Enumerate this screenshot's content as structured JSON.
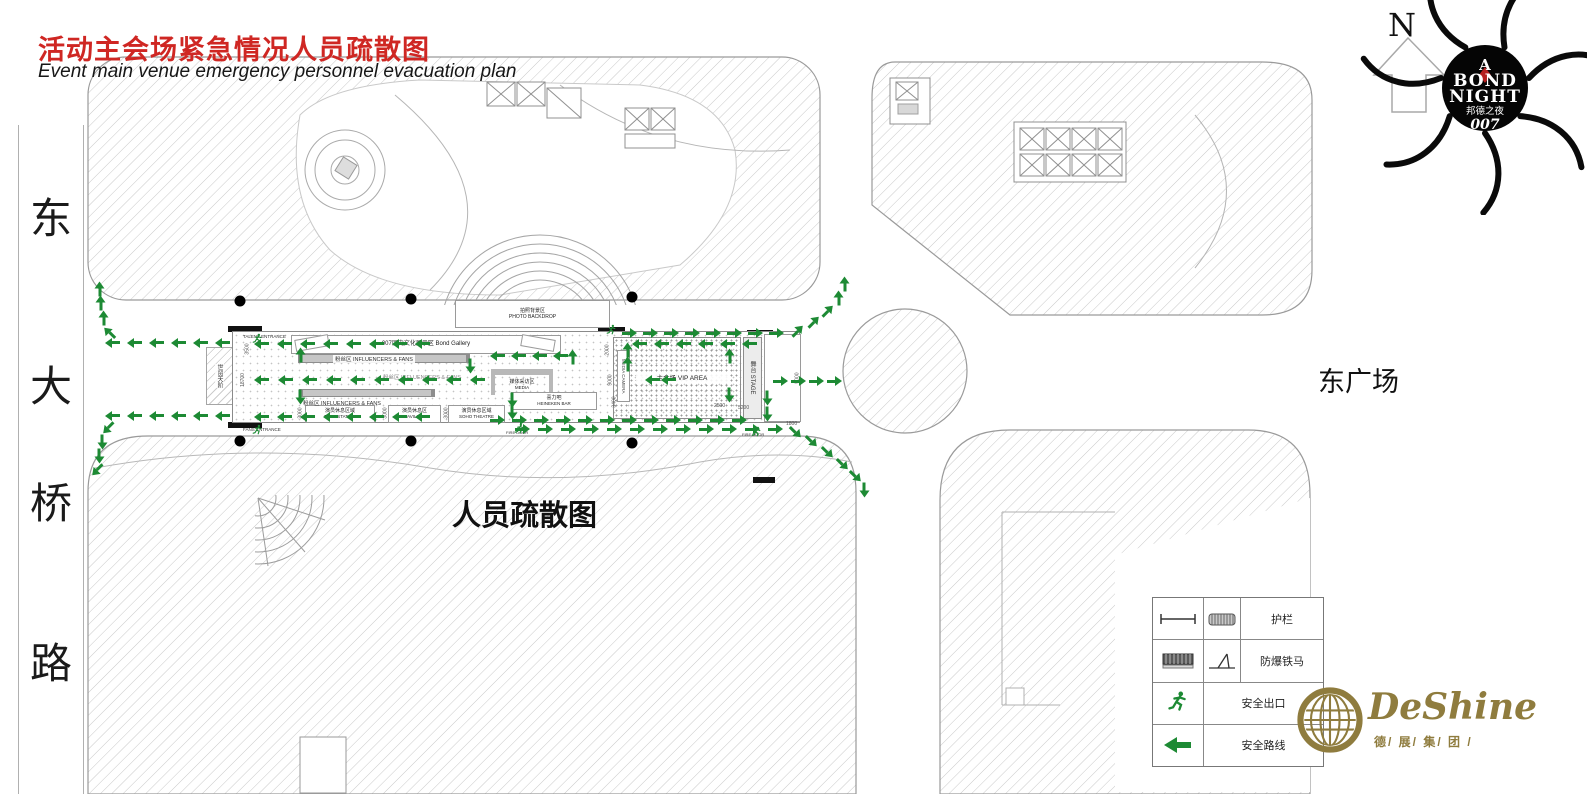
{
  "title": {
    "zh": "活动主会场紧急情况人员疏散图",
    "en": "Event main venue emergency personnel evacuation plan"
  },
  "labels": {
    "road": [
      "东",
      "大",
      "桥",
      "路"
    ],
    "east_plaza": "东广场",
    "evacuation": "人员疏散图"
  },
  "venue": {
    "photo_backdrop_zh": "拍照背景区",
    "photo_backdrop_en": "PHOTO BACKDROP",
    "bond_gallery": "007历史文化展示区  Bond Gallery",
    "fans_zone": "粉丝区 INFLUENCERS & FANS",
    "tube_station_zh": "演员休息区域",
    "tube_station_en": "TUBE STATION",
    "pavilion_zh": "演员休息区",
    "pavilion_en": "PAVILION",
    "soho_zh": "演员休息区域",
    "soho_en": "SOHO THEATRE",
    "media_zh": "媒体采访区",
    "media_en": "MEDIA",
    "heineken_zh": "喜力吧",
    "heineken_en": "HEINEKEN BAR",
    "vip": "主会场 VIP AREA",
    "stage": "舞台 STAGE",
    "media_camera": "MEDIA CAMERA",
    "the_place": "世贸天阶",
    "talent_entrance": "TALENT ENTRANCE",
    "fans_entrance": "FANS ENTRANCE",
    "fire_door": "FIRE DOOR",
    "dims": [
      "3500",
      "18700",
      "3000",
      "3000",
      "3000",
      "2000",
      "9000",
      "3400",
      "2500",
      "5200",
      "5000",
      "1800"
    ]
  },
  "legend": {
    "rows": [
      {
        "name": "guardrail",
        "label": "护栏"
      },
      {
        "name": "anti-riot-barrier",
        "label": "防爆铁马"
      },
      {
        "name": "safety-exit",
        "label": "安全出口"
      },
      {
        "name": "safety-route",
        "label": "安全路线"
      }
    ]
  },
  "compass": {
    "n": "N"
  },
  "bond_logo": {
    "a": "A",
    "bond": "BOND",
    "night": "NIGHT",
    "zh": "邦德之夜",
    "num": "007"
  },
  "deshine": {
    "name": "DeShine",
    "sub": "德/ 展/ 集/ 团 /"
  },
  "colors": {
    "title_red": "#cf2723",
    "arrow_green": "#1d8a34",
    "logo_gold": "#8f7c3e"
  }
}
